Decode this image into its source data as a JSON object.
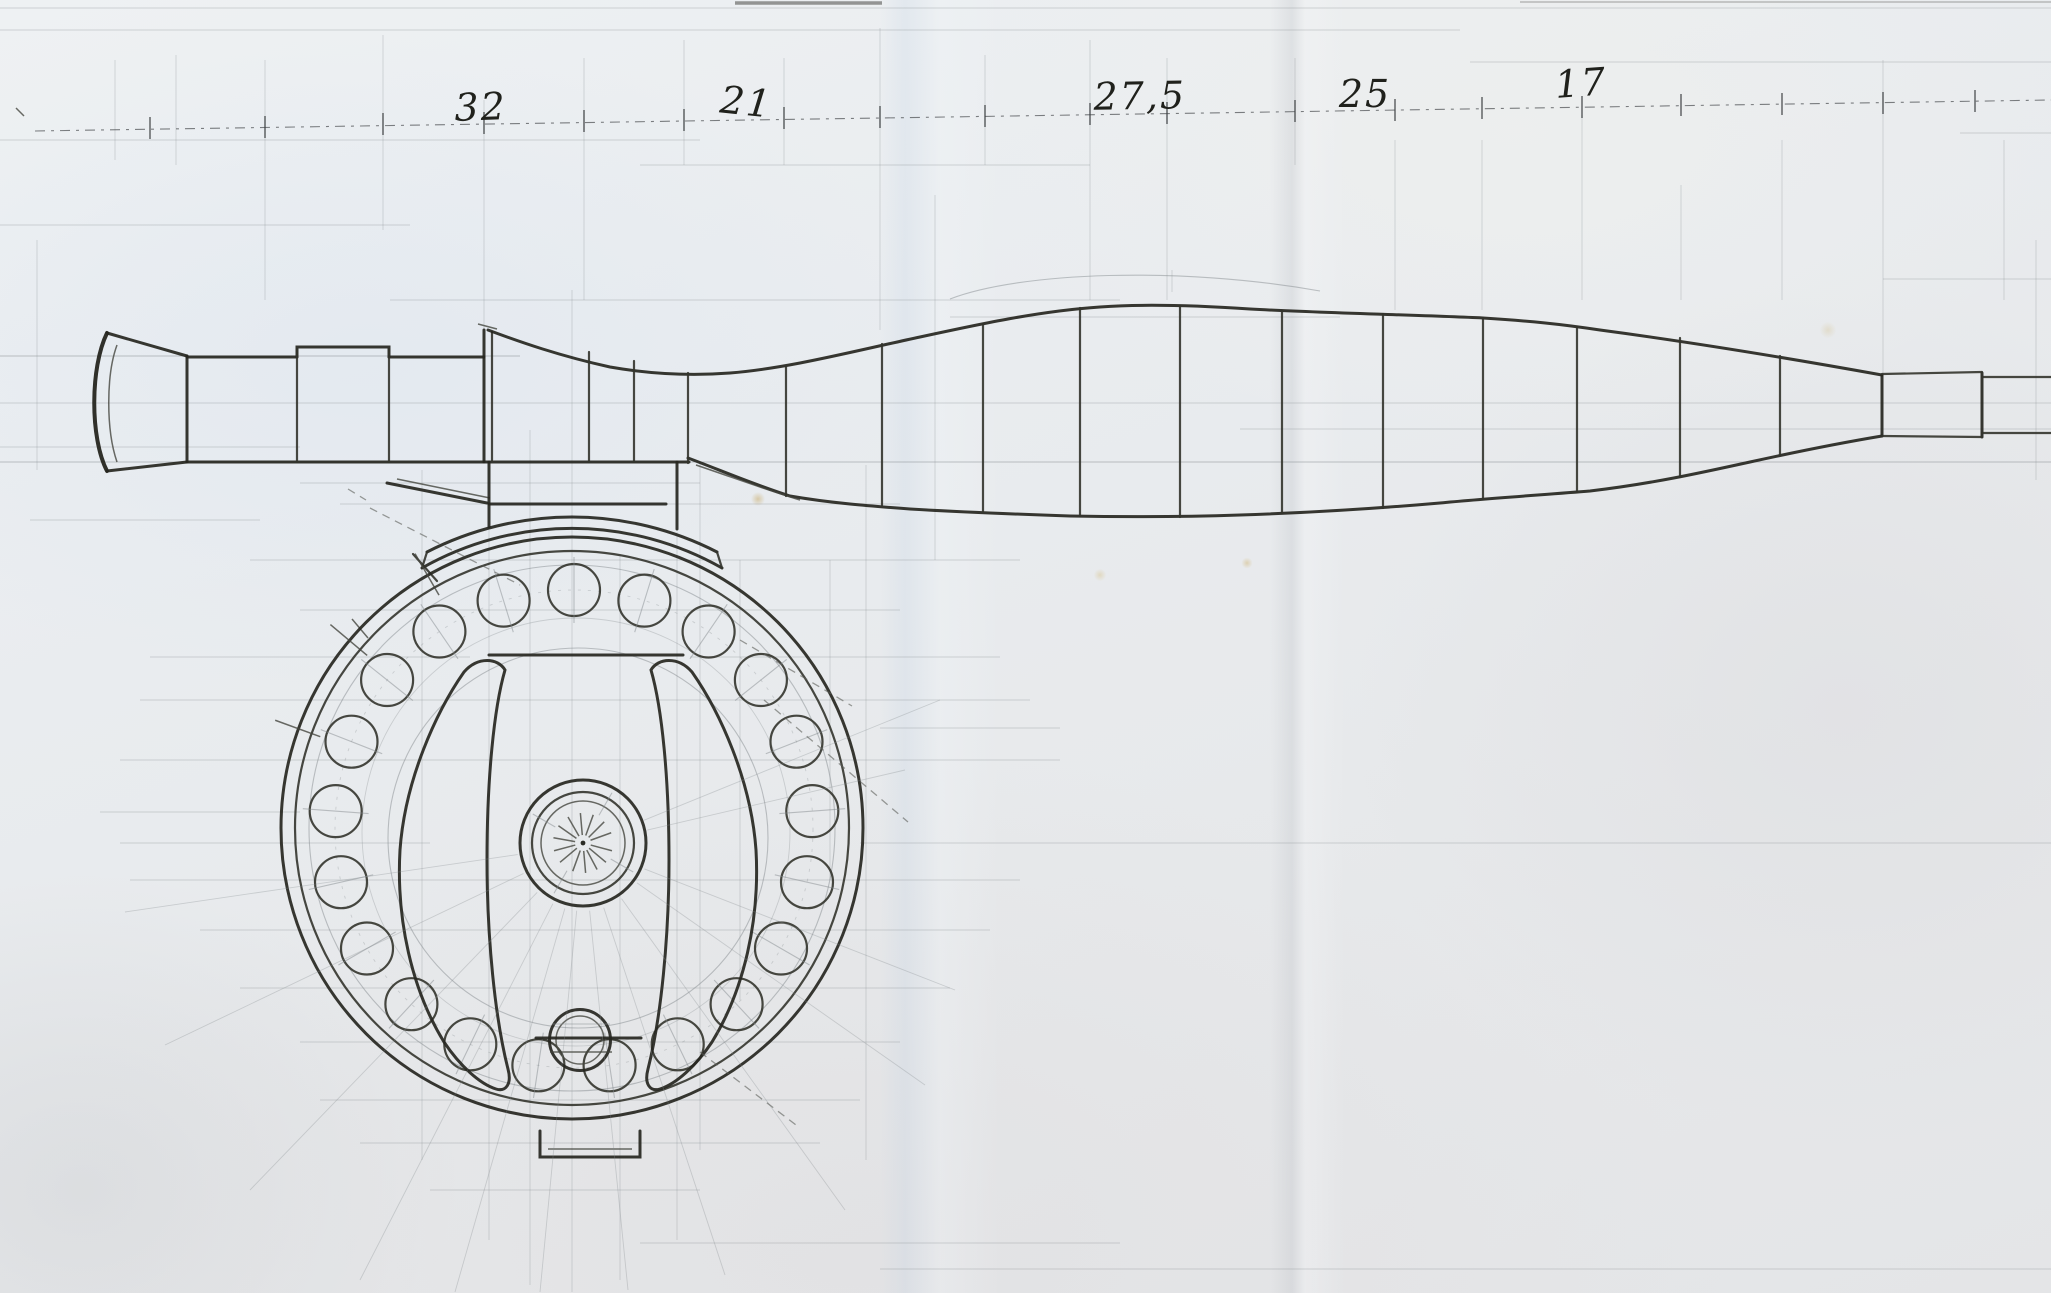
{
  "sheet": {
    "dimension_labels": [
      {
        "label": "32"
      },
      {
        "label": "21"
      },
      {
        "label": "27,5"
      },
      {
        "label": "25"
      },
      {
        "label": "17"
      }
    ],
    "reel": {
      "perforation_count": 21
    },
    "colors": {
      "paper": "#eaecee",
      "pencil": "#26261f",
      "construction": "#868b90"
    }
  }
}
